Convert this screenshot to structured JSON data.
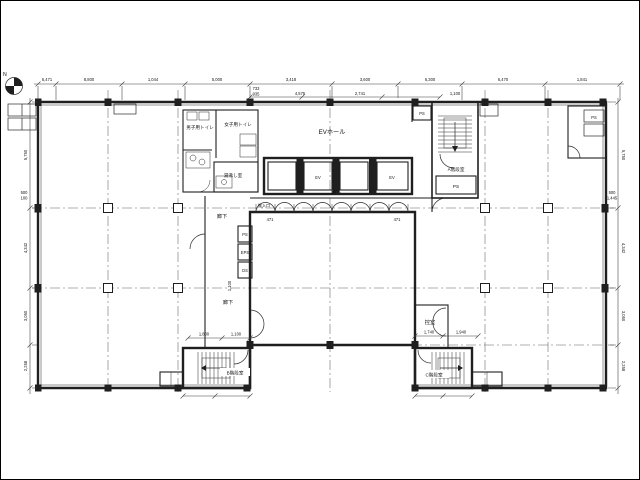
{
  "colors": {
    "ink": "#1f1f1f",
    "background": "#ffffff",
    "centerline": "#606060"
  },
  "compass": {
    "label": "N"
  },
  "rooms": {
    "ev_hall": "EVホール",
    "mens_toilet": "男子用トイレ",
    "womens_toilet": "女子用トイレ",
    "kitchenette": "湯沸し室",
    "stair_a": "A階段室",
    "stair_b": "B階段室",
    "stair_c": "C階段室",
    "anteroom": "控室",
    "corridor_top": "廊下",
    "corridor_left_upper": "廊下",
    "corridor_left_lower": "廊下",
    "loading_entrance": "搬入口",
    "shaft_ps": "PS",
    "shaft_eps": "EPS",
    "shaft_ds": "DS",
    "shaft_ps_hall": "PS",
    "shaft_ps_corner": "PS",
    "elevator_1": "EV",
    "elevator_2": "EV"
  },
  "dimensions": {
    "top": [
      "6,471",
      "8,800",
      "1,044",
      "5,000",
      "3,418",
      "3,600",
      "6,300",
      "6,470",
      "1,841"
    ],
    "top_sub": [
      "733",
      "935",
      "4,575",
      "2,741",
      "1,100"
    ],
    "left": [
      "5,750",
      "4,342",
      "3,050",
      "2,258"
    ],
    "right": [
      "5,750",
      "4,342",
      "3,050",
      "2,258"
    ],
    "left_small": [
      "500",
      "100"
    ],
    "right_small": [
      "500",
      "1,445"
    ],
    "stair_b_dims": [
      "1,800",
      "1,100"
    ],
    "stair_c_dims": [
      "1,740",
      "1,940"
    ],
    "courtyard": [
      "471",
      "471"
    ],
    "corridor_width": "1,100"
  }
}
